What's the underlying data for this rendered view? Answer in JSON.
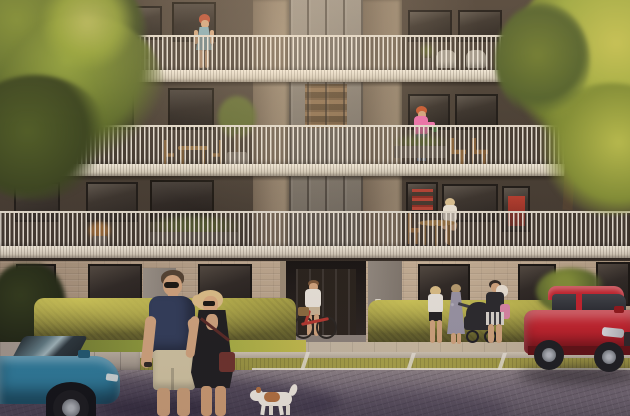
{
  "scene": {
    "description": "Sunlit rendering of a modern apartment block: three balcony levels with white vertical-slat railings over a brick ground floor with recessed entrance, hedges, sidewalk, grass-paver parking strip with white lines, cobblestone street, trees left and right",
    "people": [
      {
        "id": "balcony-woman-top",
        "note": "red-haired woman in teal dress standing on top balcony"
      },
      {
        "id": "balcony-woman-watering",
        "note": "woman in pink sweater and jeans watering plants, middle balcony"
      },
      {
        "id": "balcony-woman-seated",
        "note": "woman seated at a wooden table, lowest balcony"
      },
      {
        "id": "cyclist",
        "note": "woman in white top pushing a red bicycle at the entrance"
      },
      {
        "id": "man-foreground",
        "note": "man in navy t-shirt, khaki shorts and sunglasses looking back"
      },
      {
        "id": "woman-foreground",
        "note": "blonde woman in black open-back dress with burgundy crossbody bag"
      },
      {
        "id": "walking-woman-white-top",
        "note": "blonde woman in white top and black shorts"
      },
      {
        "id": "walking-woman-floral-dress",
        "note": "woman in long grey floral dress pushing stroller"
      },
      {
        "id": "walking-mother",
        "note": "dark-haired woman carrying a baby, pink shoulder bag"
      }
    ],
    "animals": [
      {
        "id": "dog",
        "note": "small white terrier with brown patches on cobblestones"
      }
    ],
    "vehicles": [
      {
        "id": "blue-car",
        "note": "petrol-blue sedan, front half visible bottom left"
      },
      {
        "id": "red-suv",
        "note": "red SUV parked on grass-paver strip at right"
      },
      {
        "id": "red-bicycle",
        "note": "red city bike with basket at entrance"
      },
      {
        "id": "stroller",
        "note": "black baby stroller"
      }
    ],
    "building": {
      "balcony_levels": 3,
      "railing_style": "white vertical slats",
      "ground_floor": "beige brick with full-height windows and recessed dark entrance",
      "accents": [
        "warm-lit stairwell glazing",
        "red bookshelf windows",
        "balcony plants and furniture"
      ]
    },
    "palette": {
      "facade_dark": "#453c32",
      "pier_concrete": "#877763",
      "railing_white": "#e6dfd1",
      "brick": "#b7a289",
      "hedge": "#a9a33f",
      "cobblestone": "#6f6570",
      "sidewalk": "#c0b4a2",
      "lawn": "#9aa83e",
      "tree_left": "#5c6b27",
      "tree_right": "#9aa53b",
      "blue_car": "#2a7897",
      "red_suv": "#c1202a",
      "man_tshirt": "#2e3a57",
      "man_shorts": "#cec29f",
      "woman_dress": "#1b1b1d",
      "woman_bag": "#6b3029",
      "woman_hair_blonde": "#dcbd86",
      "teal_dress": "#7fa9b4",
      "pink_sweater": "#e86fa8",
      "bicycle_red": "#b3352c",
      "dog_patch": "#b06f3e",
      "stroller_black": "#26262a",
      "watering_can_green": "#3f7a3a",
      "parking_line_white": "#e9e4d8",
      "orange_flowers": "#c47f35",
      "olive_foliage": "#5e6b2f"
    }
  }
}
